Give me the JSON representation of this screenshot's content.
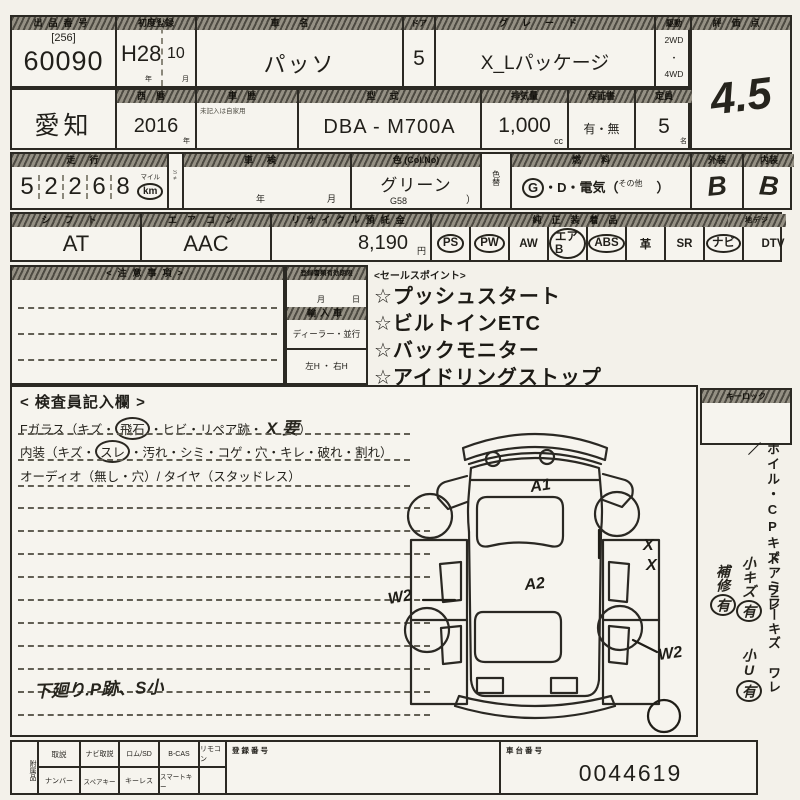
{
  "row1": {
    "auction_label": "出品番号",
    "auction_bracket": "[256]",
    "auction_no": "60090",
    "first_reg_label": "初度登録",
    "first_reg_era": "H28",
    "first_reg_month": "10",
    "year_unit": "年",
    "month_unit": "月",
    "car_name_label": "車名",
    "car_name": "パッソ",
    "door_label": "ドア",
    "door_value": "5",
    "grade_label": "グレード",
    "grade_value": "X_Lパッケージ",
    "drive_label": "駆動",
    "drive_top": "2WD",
    "drive_dot": "・",
    "drive_bottom": "4WD",
    "score_label": "評価点",
    "score_value": "4.5"
  },
  "row2": {
    "region_value": "愛知",
    "year_label": "西暦",
    "year_value": "2016",
    "year_unit": "年",
    "history_label": "車歴",
    "history_note": "未記入は自家用",
    "model_label": "型式",
    "model_value": "DBA - M700A",
    "disp_label": "排気量",
    "disp_value": "1,000",
    "disp_unit": "cc",
    "warranty_label": "保証書",
    "warranty_value": "有・無",
    "capacity_label": "定員",
    "capacity_value": "5",
    "capacity_unit": "名"
  },
  "row3": {
    "mileage_label": "走行",
    "digits": [
      "5",
      "2",
      "2",
      "6",
      "8"
    ],
    "unit_small": "マイル",
    "unit": "km",
    "flag": "S≠",
    "inspection_label": "車検",
    "insp_year": "年",
    "insp_month": "月",
    "color_label": "色 (Col.No)",
    "color_value": "グリーン",
    "color_code": "G58",
    "color_paren": "）",
    "color_change_label": "色替",
    "fuel_label": "燃料",
    "fuel_g": "G",
    "fuel_rest": "・D・電気（",
    "fuel_other": "その他",
    "fuel_close": "）",
    "exterior_label": "外装",
    "exterior_value": "B",
    "interior_label": "内装",
    "interior_value": "B"
  },
  "row4": {
    "shift_label": "シフト",
    "shift_value": "AT",
    "aircon_label": "エアコン",
    "aircon_value": "AAC",
    "recycle_label": "リサイクル預託金",
    "recycle_value": "8,190",
    "yen": "円",
    "equipment_label": "純正装着品",
    "dtv_label": "地デジ",
    "equipment": [
      {
        "label": "PS",
        "circled": true
      },
      {
        "label": "PW",
        "circled": true
      },
      {
        "label": "AW",
        "circled": false
      },
      {
        "label": "エアB",
        "circled": true
      },
      {
        "label": "ABS",
        "circled": true
      },
      {
        "label": "革",
        "circled": false
      },
      {
        "label": "SR",
        "circled": false
      },
      {
        "label": "ナビ",
        "circled": true
      },
      {
        "label": "DTV",
        "circled": false
      }
    ]
  },
  "notes_label": "<注意事項>",
  "docs": {
    "expiry_label": "登録書類有効期限",
    "month": "月",
    "day": "日",
    "import_label": "輸入車",
    "import_options": "ディーラー・並行",
    "handle_options": "左H ・ 右H"
  },
  "sales": {
    "label": "<セールスポイント>",
    "items": [
      "☆プッシュスタート",
      "☆ビルトインETC",
      "☆バックモニター",
      "☆アイドリングストップ"
    ]
  },
  "inspector": {
    "title": "< 検査員記入欄 >",
    "l1a": "Fガラス（キズ・",
    "l1b": "飛石",
    "l1c": "・ヒビ・リペア跡・",
    "l1hand": "X 要",
    "l1d": "）",
    "l2a": "内装（キズ・",
    "l2b": "スレ",
    "l2c": "・汚れ・シミ・コゲ・穴・キレ・破れ・割れ）",
    "l3": "オーディオ（無し・穴）/ タイヤ（スタッドレス）",
    "note": "下廻り.P跡、S小"
  },
  "keylock_label": "キーロック",
  "side": {
    "printed1": "ホイル・CPキズ ワレ／",
    "printed2": "ドアミラーキズ ワレ",
    "hand": [
      {
        "t": "小キズ",
        "c": "有"
      },
      {
        "t": "小U",
        "c": "有"
      },
      {
        "t": "補修",
        "c": "有"
      }
    ]
  },
  "diagram": {
    "hood": "A1",
    "roof": "A2",
    "door_x1": "X",
    "door_x2": "X",
    "left_mark": "W2",
    "right_mark": "W2"
  },
  "bottom": {
    "acc_label": "附属品",
    "top_cells": [
      "取説",
      "ナビ取説",
      "ロム/SD",
      "B-CAS",
      "リモコン"
    ],
    "bottom_cells": [
      "ナンバー",
      "スペアキー",
      "キーレス",
      "スマートキー",
      ""
    ],
    "reg_label": "登録番号",
    "chassis_label": "車台番号",
    "chassis_value": "0044619"
  }
}
